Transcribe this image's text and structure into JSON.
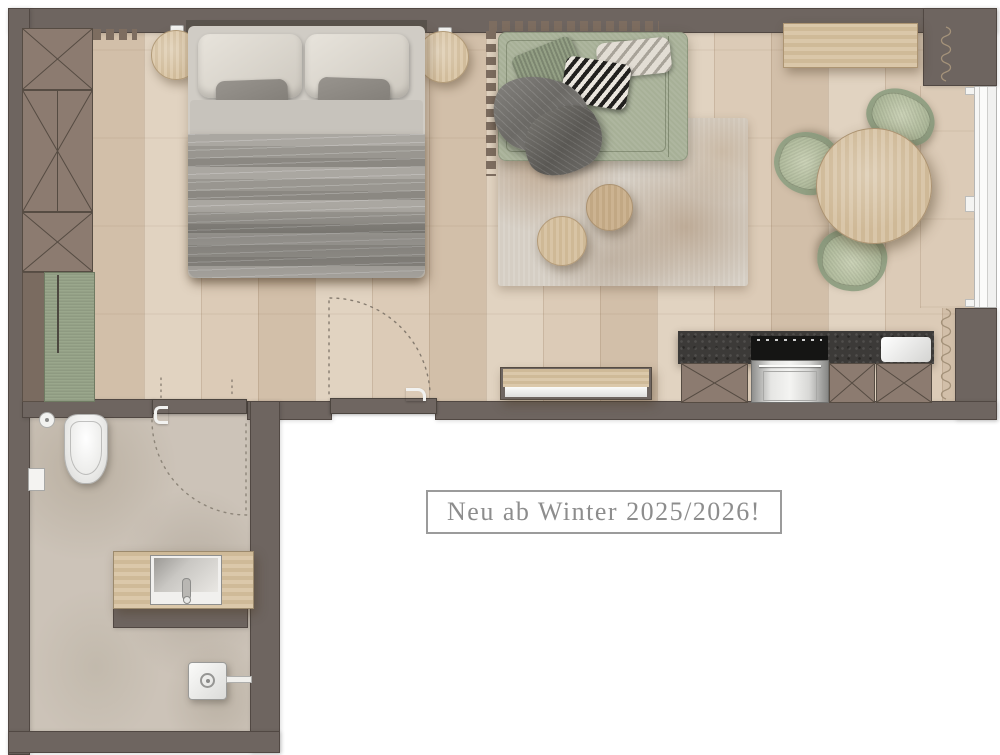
{
  "label": {
    "text": "Neu ab Winter 2025/2026!"
  },
  "palette": {
    "wall": "#6e6560",
    "wall_outline": "#4e4740",
    "wood_floor": "#d9c8b4",
    "furniture_wood": "#d5c0a0",
    "upholstery_green": "#9dab8f",
    "cushion_green_light": "#c2cab0",
    "counter_stone": "#3c3a38",
    "bathroom_floor": "#ccc3b8",
    "bed_blanket": "#8e8c87",
    "pillow_light": "#d8d3cb",
    "rug_base": "#d5cec4",
    "label_text": "#8d8d8d",
    "label_border": "#9b9b9b"
  },
  "furniture_icons": [
    "wardrobe-icon",
    "green-bench-icon",
    "double-bed-icon",
    "nightstand-icon",
    "wall-lamp-icon",
    "sofa-daybed-icon",
    "throw-blanket-icon",
    "woven-cushion-icon",
    "geometric-cushion-icon",
    "chevron-cushion-icon",
    "area-rug-icon",
    "coffee-table-icon",
    "dining-table-icon",
    "dining-chair-icon",
    "sideboard-icon",
    "entry-bench-icon",
    "kitchen-counter-icon",
    "cooktop-icon",
    "oven-icon",
    "kitchen-sink-icon",
    "base-cabinet-icon",
    "radiator-icon",
    "curtain-icon",
    "window-icon",
    "door-swing-arc-icon",
    "toilet-icon",
    "toilet-paper-holder-icon",
    "wall-niche-icon",
    "vanity-sink-icon",
    "faucet-icon",
    "shower-fixture-icon"
  ]
}
